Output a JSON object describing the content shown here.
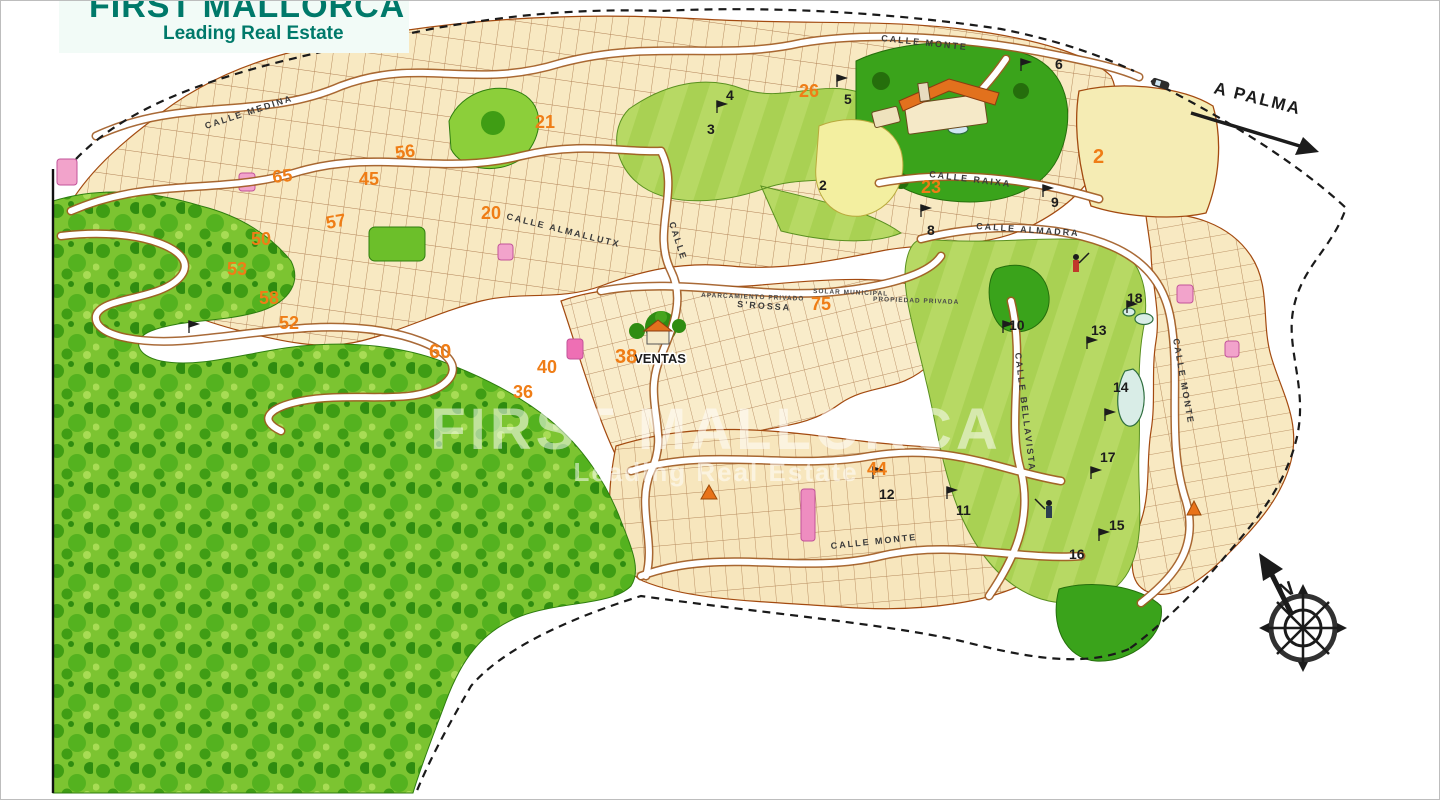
{
  "branding": {
    "title": "FIRST MALLORCA",
    "tagline": "Leading Real Estate",
    "color": "#00796a"
  },
  "watermark": {
    "title": "FIRST MALLORCA",
    "tagline": "Leading Real Estate"
  },
  "map": {
    "direction": "A PALMA",
    "compass_north": "N",
    "sales_office": "VENTAS",
    "streets": [
      "CALLE MONTE",
      "CALLE RAIXA",
      "CALLE ALMADRA",
      "CALLE ALMALLUTX",
      "CALLE MEDINA",
      "CALLE BELLAVISTA",
      "CALLE MONTE",
      "S'ROSSA",
      "CALLE MONTE",
      "CALLE"
    ],
    "areas": [
      "APARCAMIENTO PRIVADO",
      "SOLAR MUNICIPAL",
      "PROPIEDAD PRIVADA"
    ],
    "zones": [
      "65",
      "45",
      "56",
      "21",
      "20",
      "57",
      "50",
      "53",
      "58",
      "52",
      "60",
      "40",
      "38",
      "36",
      "26",
      "23",
      "2",
      "75",
      "44"
    ],
    "holes": [
      "6",
      "5",
      "4",
      "3",
      "2",
      "8",
      "9",
      "18",
      "13",
      "10",
      "14",
      "17",
      "11",
      "12",
      "15",
      "16"
    ],
    "colors": {
      "parcel": "#f8e9c2",
      "parcel_line": "#8a4a1a",
      "road_casing": "#a05a22",
      "forest": "#7cc431",
      "forest_dark": "#3f9d14",
      "fairway": "#b7d964",
      "green_dark": "#3aa31b",
      "pond": "#d9ede7",
      "yellow_zone": "#f3efa0",
      "pink_zone": "#f2a3cb",
      "zone_number": "#ef7d16",
      "boundary": "#1a1a1a"
    }
  }
}
